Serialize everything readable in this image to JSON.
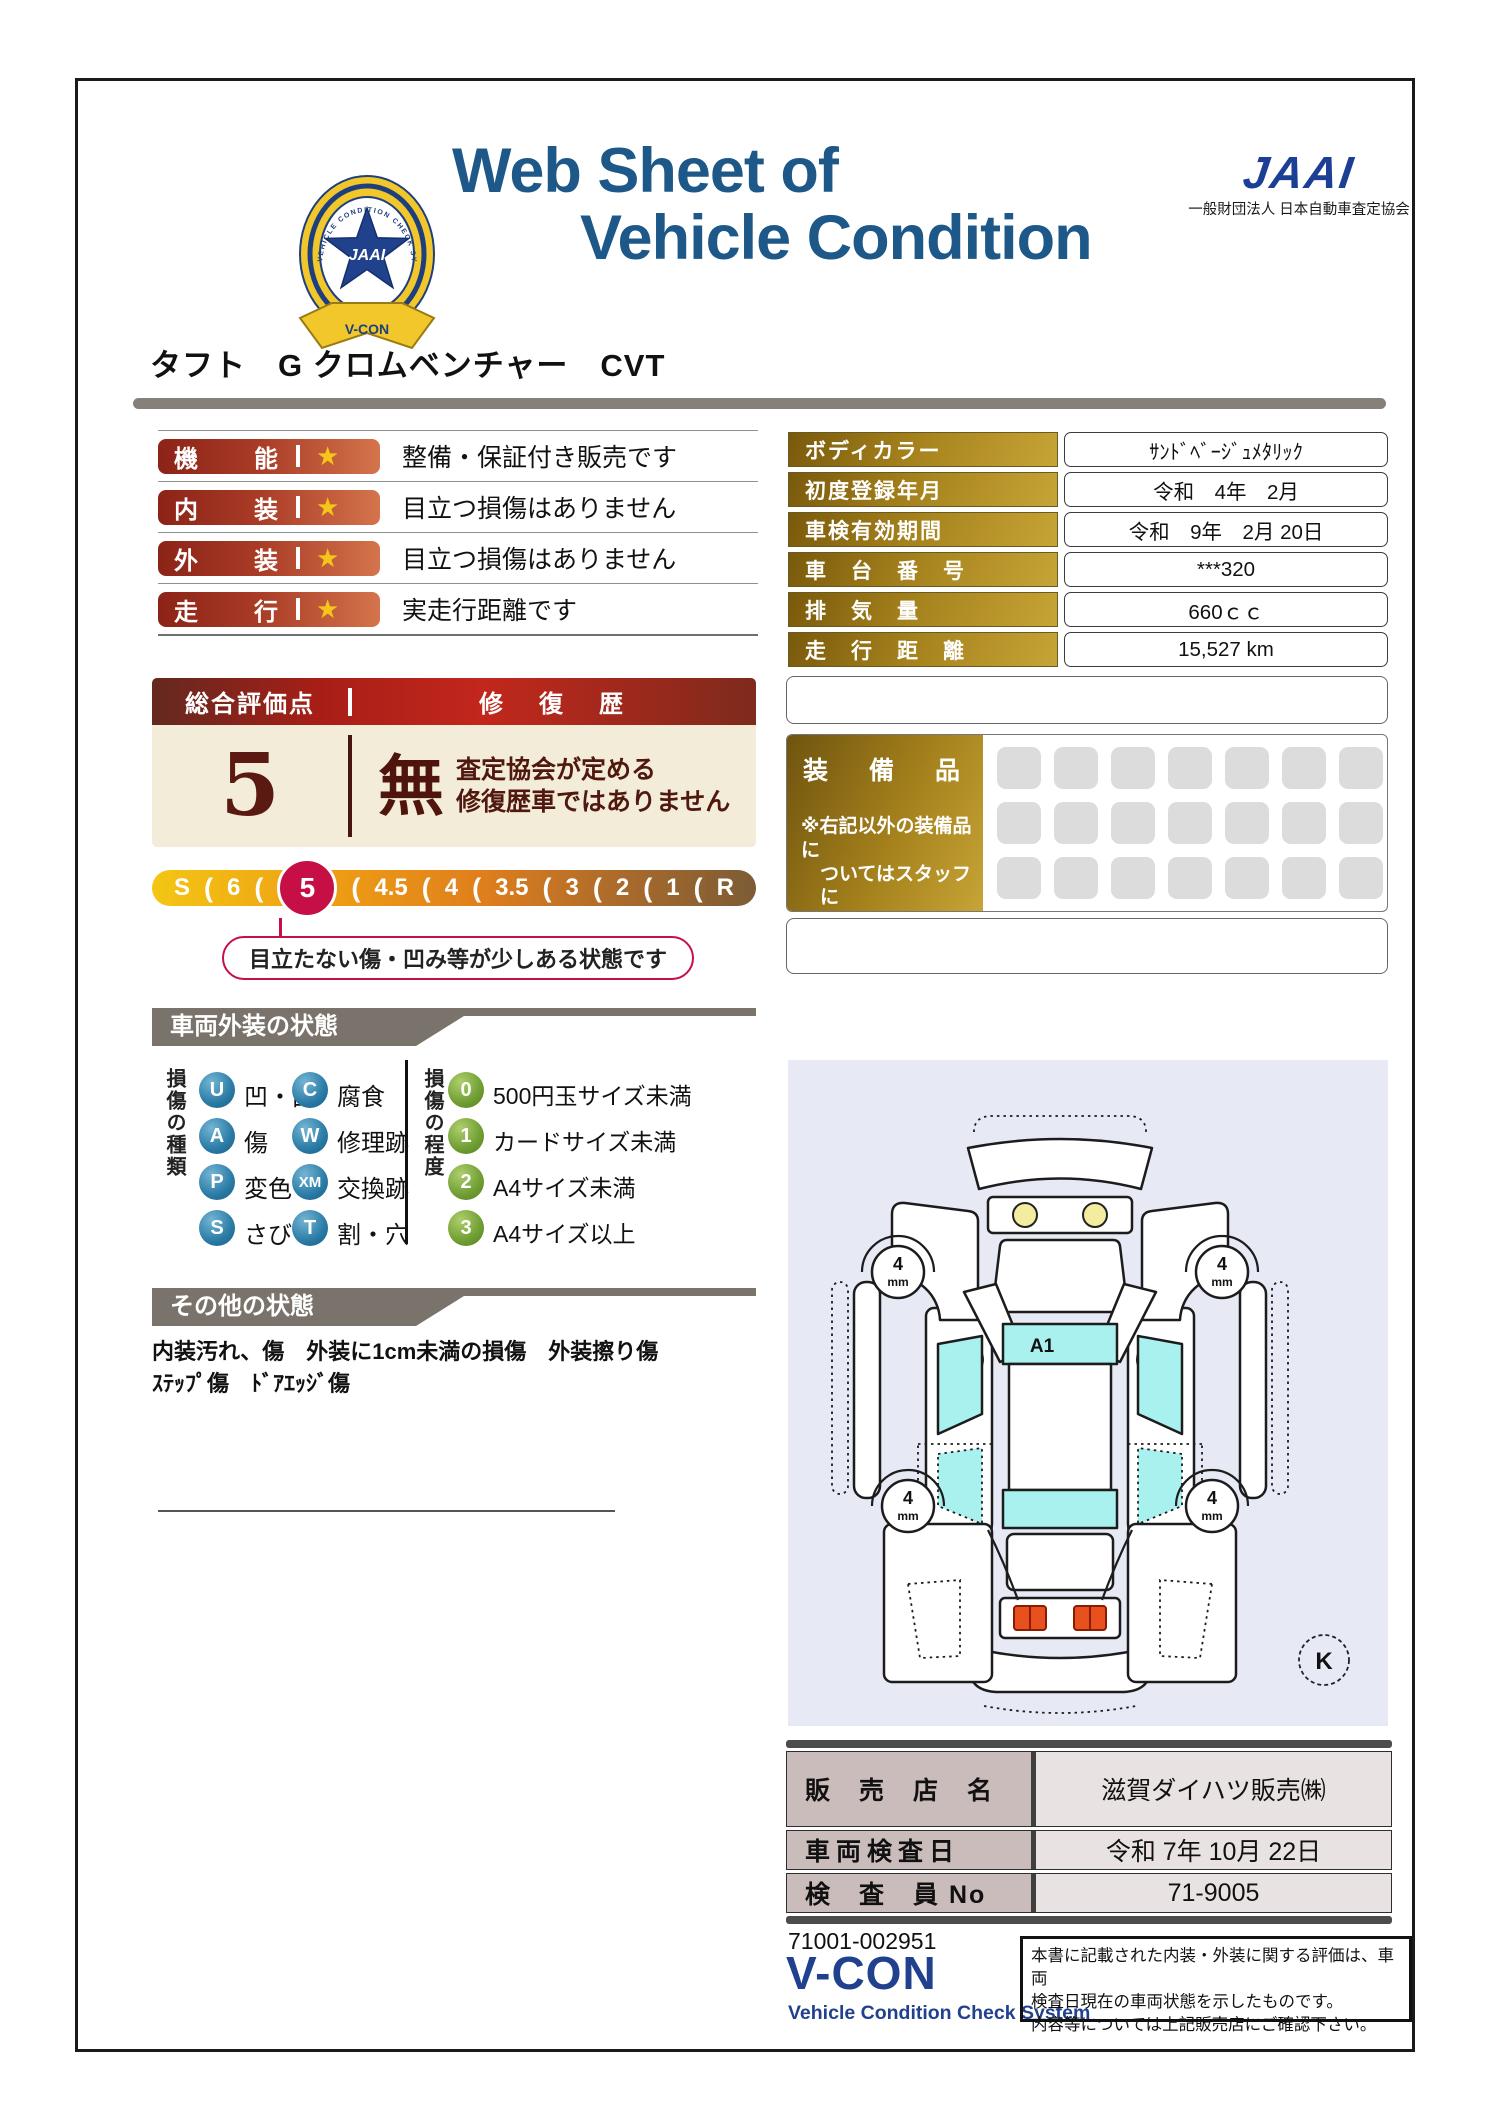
{
  "header": {
    "title_line1": "Web Sheet of",
    "title_line2": "Vehicle Condition",
    "badge_ring_text": "VEHICLE CONDITION CHECK SYSTEM",
    "badge_star_text": "JAAI",
    "badge_ribbon_text": "V-CON",
    "jaai_logo_text": "JAAI",
    "jaai_org_text": "一般財団法人 日本自動車査定協会"
  },
  "vehicle_name": "タフト　G クロムベンチャー　CVT",
  "glyphs": {
    "star": "★",
    "separator": "("
  },
  "ratings": [
    {
      "label_left": "機",
      "label_right": "能",
      "description": "整備・保証付き販売です"
    },
    {
      "label_left": "内",
      "label_right": "装",
      "description": "目立つ損傷はありません"
    },
    {
      "label_left": "外",
      "label_right": "装",
      "description": "目立つ損傷はありません"
    },
    {
      "label_left": "走",
      "label_right": "行",
      "description": "実走行距離です"
    }
  ],
  "vehicle_info": {
    "rows": [
      {
        "label": "ボディカラー",
        "value": "ｻﾝﾄﾞﾍﾞｰｼﾞｭﾒﾀﾘｯｸ"
      },
      {
        "label": "初度登録年月",
        "value": "令和　4年　2月"
      },
      {
        "label": "車検有効期間",
        "value": "令和　9年　2月 20日"
      },
      {
        "label": "車　台　番　号",
        "value": "***320"
      },
      {
        "label": "排　気　量",
        "value": "660ｃｃ"
      },
      {
        "label": "走　行　距　離",
        "value": "15,527 km"
      }
    ]
  },
  "overall": {
    "header_left": "総合評価点",
    "header_right": "修　復　歴",
    "score": "5",
    "repair_value": "無",
    "repair_note_line1": "査定協会が定める",
    "repair_note_line2": "修復歴車ではありません"
  },
  "scale": {
    "items": [
      "S",
      "6",
      "5",
      "4.5",
      "4",
      "3.5",
      "3",
      "2",
      "1",
      "R"
    ],
    "selected_value": "5",
    "callout": "目立たない傷・凹み等が少しある状態です"
  },
  "exterior": {
    "title": "車両外装の状態",
    "type_group_label": "損傷の種類",
    "degree_group_label": "損傷の程度",
    "types": [
      {
        "code": "U",
        "label": "凹・曲"
      },
      {
        "code": "A",
        "label": "傷"
      },
      {
        "code": "P",
        "label": "変色"
      },
      {
        "code": "S",
        "label": "さび"
      },
      {
        "code": "C",
        "label": "腐食"
      },
      {
        "code": "W",
        "label": "修理跡"
      },
      {
        "code": "XM",
        "label": "交換跡"
      },
      {
        "code": "T",
        "label": "割・穴"
      }
    ],
    "degrees": [
      {
        "code": "0",
        "label": "500円玉サイズ未満"
      },
      {
        "code": "1",
        "label": "カードサイズ未満"
      },
      {
        "code": "2",
        "label": "A4サイズ未満"
      },
      {
        "code": "3",
        "label": "A4サイズ以上"
      }
    ]
  },
  "other": {
    "title": "その他の状態",
    "line1": "内装汚れ、傷　外装に1cm未満の損傷　外装擦り傷",
    "line2": "ｽﾃｯﾌﾟ傷　ﾄﾞｱｴｯｼﾞ傷"
  },
  "equipment": {
    "title": "装　備　品",
    "note_line1": "※右記以外の装備品に",
    "note_line2": "ついてはスタッフに",
    "note_line3": "お尋ねください。"
  },
  "diagram": {
    "windshield_label": "A1",
    "tread_value": "4",
    "tread_unit": "mm",
    "key_label": "K"
  },
  "dealer": {
    "rows": [
      {
        "label": "販　売　店　名",
        "value": "滋賀ダイハツ販売㈱"
      },
      {
        "label": "車両検査日",
        "value": "令和 7年 10月 22日"
      },
      {
        "label": "検　査　員 No",
        "value": "71-9005"
      }
    ]
  },
  "footer": {
    "doc_number": "71001-002951",
    "vcon_title": "V-CON",
    "vcon_subtitle": "Vehicle Condition Check System",
    "disclaimer_line1": "本書に記載された内装・外装に関する評価は、車両",
    "disclaimer_line2": "検査日現在の車両状態を示したものです。",
    "disclaimer_line3": "内容等については上記販売店にご確認下さい。"
  }
}
